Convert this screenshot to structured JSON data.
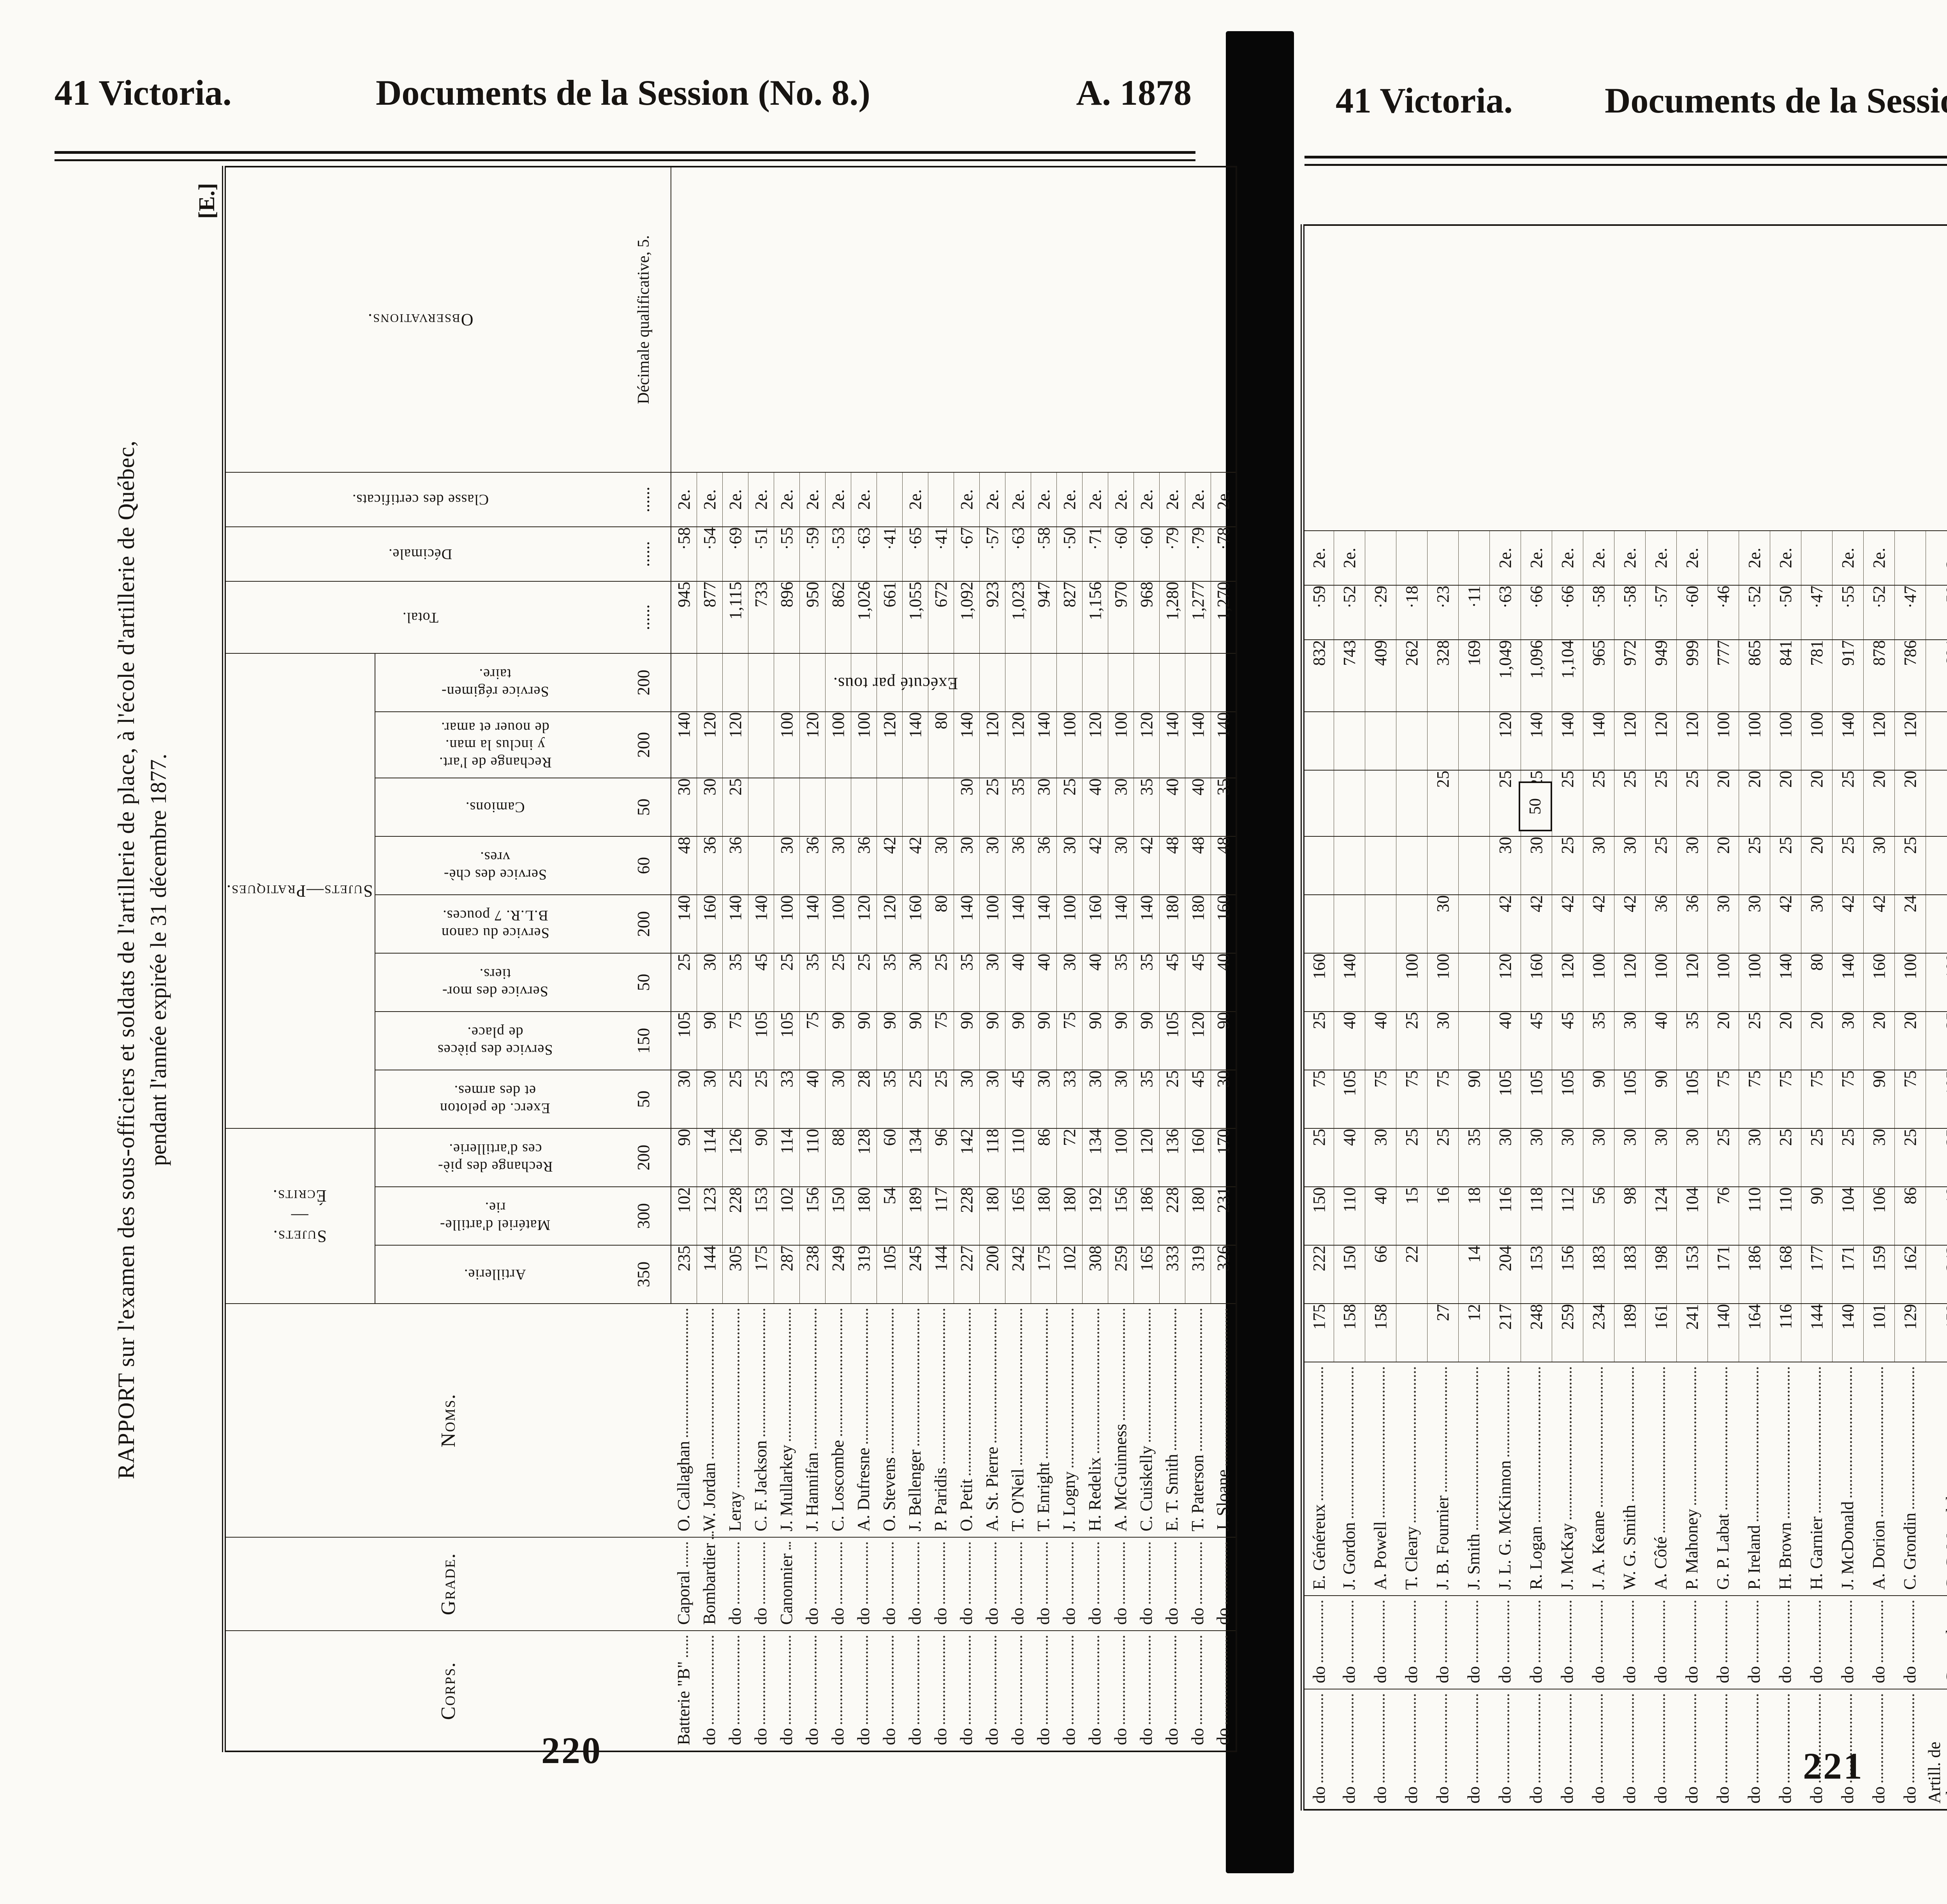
{
  "left_page": {
    "header_left": "41 Victoria.",
    "header_center": "Documents de la Session (No. 8.)",
    "header_right": "A. 1878",
    "section_mark": "[E.]",
    "title_line1": "RAPPORT sur l'examen des sous-officiers et soldats de l'artillerie de place, à l'école d'artillerie de Québec,",
    "title_line2": "pendant l'année expirée le 31 décembre 1877.",
    "page_number": "220"
  },
  "right_page": {
    "header_left": "41 Victoria.",
    "header_center": "Documents de la Session (No. 8.)",
    "header_right": "- 1878.",
    "page_number": "221",
    "signature_line1": "T. B. STRANGE, lieut.-colonel,",
    "signature_line2": "Commandant l'école d'artillerie, Québec."
  },
  "table": {
    "group_ecrits": "Sujets.\n—\nÉcrits.",
    "group_pratiques": "Sujets—Pratiques.",
    "h_corps": "Corps.",
    "h_grade": "Grade.",
    "h_noms": "Noms.",
    "h_art": "Artillerie.",
    "h_mat": "Matériel d'artille-\nrie.",
    "h_rchp": "Rechange des piè-\nces d'artillerie.",
    "h_pel": "Exerc. de peloton\net des armes.",
    "h_plc": "Service des pièces\nde place.",
    "h_mrt": "Service des mor-\ntiers.",
    "h_blr": "Service du canon\nB.L.R. 7 pouces.",
    "h_chv": "Service des chè-\nvres.",
    "h_cam": "Camions.",
    "h_rca": "Rechange de l'art.\ny inclus la man.\nde nouer et amar.",
    "h_srg": "Service régimen-\ntaire.",
    "h_tot": "Total.",
    "h_dec": "Décimale.",
    "h_cls": "Classe des certificats.",
    "h_obs": "Observations.",
    "obs_note": "Décimale qualificative, 5.",
    "execute_note": "Exécuté par tous.",
    "box_50": "50",
    "box_200": "200",
    "max": {
      "art": "350",
      "mat": "300",
      "rchp": "200",
      "pel": "50",
      "plc": "150",
      "mrt": "50",
      "blr": "200",
      "chv": "60",
      "cam": "50",
      "rca": "200",
      "srg": "200",
      "tot": "......",
      "dec": "......",
      "cls": "......"
    }
  },
  "rows_left": [
    {
      "corps": "Batterie \"B\"",
      "grade": "Caporal",
      "name": "O. Callaghan",
      "art": "235",
      "mat": "102",
      "rchp": "90",
      "pel": "30",
      "plc": "105",
      "mrt": "25",
      "blr": "140",
      "chv": "48",
      "cam": "30",
      "rca": "140",
      "srg": "",
      "tot": "945",
      "dec": "·58",
      "cls": "2e."
    },
    {
      "corps": "do",
      "grade": "Bombardier",
      "name": "W. Jordan",
      "art": "144",
      "mat": "123",
      "rchp": "114",
      "pel": "30",
      "plc": "90",
      "mrt": "30",
      "blr": "160",
      "chv": "36",
      "cam": "30",
      "rca": "120",
      "srg": "",
      "tot": "877",
      "dec": "·54",
      "cls": "2e."
    },
    {
      "corps": "do",
      "grade": "do",
      "name": "Leray",
      "art": "305",
      "mat": "228",
      "rchp": "126",
      "pel": "25",
      "plc": "75",
      "mrt": "35",
      "blr": "140",
      "chv": "36",
      "cam": "25",
      "rca": "120",
      "srg": "",
      "tot": "1,115",
      "dec": "·69",
      "cls": "2e."
    },
    {
      "corps": "do",
      "grade": "do",
      "name": "C. F. Jackson",
      "art": "175",
      "mat": "153",
      "rchp": "90",
      "pel": "25",
      "plc": "105",
      "mrt": "45",
      "blr": "140",
      "chv": "",
      "cam": "",
      "rca": "",
      "srg": "",
      "tot": "733",
      "dec": "·51",
      "cls": "2e."
    },
    {
      "corps": "do",
      "grade": "Canonnier",
      "name": "J. Mullarkey",
      "art": "287",
      "mat": "102",
      "rchp": "114",
      "pel": "33",
      "plc": "105",
      "mrt": "25",
      "blr": "100",
      "chv": "30",
      "cam": "",
      "rca": "100",
      "srg": "",
      "tot": "896",
      "dec": "·55",
      "cls": "2e."
    },
    {
      "corps": "do",
      "grade": "do",
      "name": "J. Hannifan",
      "art": "238",
      "mat": "156",
      "rchp": "110",
      "pel": "40",
      "plc": "75",
      "mrt": "35",
      "blr": "140",
      "chv": "36",
      "cam": "",
      "rca": "120",
      "srg": "",
      "tot": "950",
      "dec": "·59",
      "cls": "2e."
    },
    {
      "corps": "do",
      "grade": "do",
      "name": "C. Loscombe",
      "art": "249",
      "mat": "150",
      "rchp": "88",
      "pel": "30",
      "plc": "90",
      "mrt": "25",
      "blr": "100",
      "chv": "30",
      "cam": "",
      "rca": "100",
      "srg": "",
      "tot": "862",
      "dec": "·53",
      "cls": "2e."
    },
    {
      "corps": "do",
      "grade": "do",
      "name": "A. Dufresne",
      "art": "319",
      "mat": "180",
      "rchp": "128",
      "pel": "28",
      "plc": "90",
      "mrt": "25",
      "blr": "120",
      "chv": "36",
      "cam": "",
      "rca": "100",
      "srg": "",
      "tot": "1,026",
      "dec": "·63",
      "cls": "2e."
    },
    {
      "corps": "do",
      "grade": "do",
      "name": "O. Stevens",
      "art": "105",
      "mat": "54",
      "rchp": "60",
      "pel": "35",
      "plc": "90",
      "mrt": "35",
      "blr": "120",
      "chv": "42",
      "cam": "",
      "rca": "120",
      "srg": "",
      "tot": "661",
      "dec": "·41",
      "cls": ""
    },
    {
      "corps": "do",
      "grade": "do",
      "name": "J. Bellenger",
      "art": "245",
      "mat": "189",
      "rchp": "134",
      "pel": "25",
      "plc": "90",
      "mrt": "30",
      "blr": "160",
      "chv": "42",
      "cam": "",
      "rca": "140",
      "srg": "",
      "tot": "1,055",
      "dec": "·65",
      "cls": "2e."
    },
    {
      "corps": "do",
      "grade": "do",
      "name": "P. Paridis",
      "art": "144",
      "mat": "117",
      "rchp": "96",
      "pel": "25",
      "plc": "75",
      "mrt": "25",
      "blr": "80",
      "chv": "30",
      "cam": "",
      "rca": "80",
      "srg": "",
      "tot": "672",
      "dec": "·41",
      "cls": ""
    },
    {
      "corps": "do",
      "grade": "do",
      "name": "O. Petit",
      "art": "227",
      "mat": "228",
      "rchp": "142",
      "pel": "30",
      "plc": "90",
      "mrt": "35",
      "blr": "140",
      "chv": "30",
      "cam": "30",
      "rca": "140",
      "srg": "",
      "tot": "1,092",
      "dec": "·67",
      "cls": "2e."
    },
    {
      "corps": "do",
      "grade": "do",
      "name": "A. St. Pierre",
      "art": "200",
      "mat": "180",
      "rchp": "118",
      "pel": "30",
      "plc": "90",
      "mrt": "30",
      "blr": "100",
      "chv": "30",
      "cam": "25",
      "rca": "120",
      "srg": "",
      "tot": "923",
      "dec": "·57",
      "cls": "2e."
    },
    {
      "corps": "do",
      "grade": "do",
      "name": "T. O'Neil",
      "art": "242",
      "mat": "165",
      "rchp": "110",
      "pel": "45",
      "plc": "90",
      "mrt": "40",
      "blr": "140",
      "chv": "36",
      "cam": "35",
      "rca": "120",
      "srg": "",
      "tot": "1,023",
      "dec": "·63",
      "cls": "2e."
    },
    {
      "corps": "do",
      "grade": "do",
      "name": "T. Enright",
      "art": "175",
      "mat": "180",
      "rchp": "86",
      "pel": "30",
      "plc": "90",
      "mrt": "40",
      "blr": "140",
      "chv": "36",
      "cam": "30",
      "rca": "140",
      "srg": "",
      "tot": "947",
      "dec": "·58",
      "cls": "2e."
    },
    {
      "corps": "do",
      "grade": "do",
      "name": "J. Logny",
      "art": "102",
      "mat": "180",
      "rchp": "72",
      "pel": "33",
      "plc": "75",
      "mrt": "30",
      "blr": "100",
      "chv": "30",
      "cam": "25",
      "rca": "100",
      "srg": "",
      "tot": "827",
      "dec": "·50",
      "cls": "2e."
    },
    {
      "corps": "do",
      "grade": "do",
      "name": "H. Redelix",
      "art": "308",
      "mat": "192",
      "rchp": "134",
      "pel": "30",
      "plc": "90",
      "mrt": "40",
      "blr": "160",
      "chv": "42",
      "cam": "40",
      "rca": "120",
      "srg": "",
      "tot": "1,156",
      "dec": "·71",
      "cls": "2e."
    },
    {
      "corps": "do",
      "grade": "do",
      "name": "A. McGuinness",
      "art": "259",
      "mat": "156",
      "rchp": "100",
      "pel": "30",
      "plc": "90",
      "mrt": "35",
      "blr": "140",
      "chv": "30",
      "cam": "30",
      "rca": "100",
      "srg": "",
      "tot": "970",
      "dec": "·60",
      "cls": "2e."
    },
    {
      "corps": "do",
      "grade": "do",
      "name": "C. Cuiskelly",
      "art": "165",
      "mat": "186",
      "rchp": "120",
      "pel": "35",
      "plc": "90",
      "mrt": "35",
      "blr": "140",
      "chv": "42",
      "cam": "35",
      "rca": "120",
      "srg": "",
      "tot": "968",
      "dec": "·60",
      "cls": "2e."
    },
    {
      "corps": "do",
      "grade": "do",
      "name": "E. T. Smith",
      "art": "333",
      "mat": "228",
      "rchp": "136",
      "pel": "25",
      "plc": "105",
      "mrt": "45",
      "blr": "180",
      "chv": "48",
      "cam": "40",
      "rca": "140",
      "srg": "",
      "tot": "1,280",
      "dec": "·79",
      "cls": "2e."
    },
    {
      "corps": "do",
      "grade": "do",
      "name": "T. Paterson",
      "art": "319",
      "mat": "180",
      "rchp": "160",
      "pel": "45",
      "plc": "120",
      "mrt": "45",
      "blr": "180",
      "chv": "48",
      "cam": "40",
      "rca": "140",
      "srg": "",
      "tot": "1,277",
      "dec": "·79",
      "cls": "2e."
    },
    {
      "corps": "do",
      "grade": "do",
      "name": "J. Sloane",
      "art": "326",
      "mat": "231",
      "rchp": "170",
      "pel": "30",
      "plc": "90",
      "mrt": "40",
      "blr": "160",
      "chv": "48",
      "cam": "35",
      "rca": "140",
      "srg": "",
      "tot": "1,270",
      "dec": "·78",
      "cls": "2e."
    }
  ],
  "rows_right": [
    {
      "corps": "do",
      "grade": "do",
      "name": "E. Généreux",
      "art": "175",
      "mat": "222",
      "rchp": "150",
      "pel": "25",
      "plc": "75",
      "mrt": "25",
      "blr": "160",
      "chv": "",
      "cam": "",
      "rca": "",
      "srg": "",
      "tot": "832",
      "dec": "·59",
      "cls": "2e."
    },
    {
      "corps": "do",
      "grade": "do",
      "name": "J. Gordon",
      "art": "158",
      "mat": "150",
      "rchp": "110",
      "pel": "40",
      "plc": "105",
      "mrt": "40",
      "blr": "140",
      "chv": "",
      "cam": "",
      "rca": "",
      "srg": "",
      "tot": "743",
      "dec": "·52",
      "cls": "2e."
    },
    {
      "corps": "do",
      "grade": "do",
      "name": "A. Powell",
      "art": "158",
      "mat": "66",
      "rchp": "40",
      "pel": "30",
      "plc": "75",
      "mrt": "40",
      "blr": "",
      "chv": "",
      "cam": "",
      "rca": "",
      "srg": "",
      "tot": "409",
      "dec": "·29",
      "cls": ""
    },
    {
      "corps": "do",
      "grade": "do",
      "name": "T. Cleary",
      "art": "",
      "mat": "22",
      "rchp": "15",
      "pel": "25",
      "plc": "75",
      "mrt": "25",
      "blr": "100",
      "chv": "",
      "cam": "",
      "rca": "",
      "srg": "",
      "tot": "262",
      "dec": "·18",
      "cls": ""
    },
    {
      "corps": "do",
      "grade": "do",
      "name": "J. B. Fournier",
      "art": "27",
      "mat": "",
      "rchp": "16",
      "pel": "25",
      "plc": "75",
      "mrt": "30",
      "blr": "100",
      "chv": "30",
      "cam": "",
      "rca": "25",
      "srg": "",
      "tot": "328",
      "dec": "·23",
      "cls": ""
    },
    {
      "corps": "do",
      "grade": "do",
      "name": "J. Smith",
      "art": "12",
      "mat": "14",
      "rchp": "18",
      "pel": "35",
      "plc": "90",
      "mrt": "",
      "blr": "",
      "chv": "",
      "cam": "",
      "rca": "",
      "srg": "",
      "tot": "169",
      "dec": "·11",
      "cls": ""
    },
    {
      "corps": "do",
      "grade": "do",
      "name": "J. L. G. McKinnon",
      "art": "217",
      "mat": "204",
      "rchp": "116",
      "pel": "30",
      "plc": "105",
      "mrt": "40",
      "blr": "120",
      "chv": "42",
      "cam": "30",
      "rca": "25",
      "srg": "120",
      "tot": "1,049",
      "dec": "·63",
      "cls": "2e."
    },
    {
      "corps": "do",
      "grade": "do",
      "name": "R. Logan",
      "art": "248",
      "mat": "153",
      "rchp": "118",
      "pel": "30",
      "plc": "105",
      "mrt": "45",
      "blr": "160",
      "chv": "42",
      "cam": "30",
      "rca": "25",
      "srg": "140",
      "tot": "1,096",
      "dec": "·66",
      "cls": "2e."
    },
    {
      "corps": "do",
      "grade": "do",
      "name": "J. McKay",
      "art": "259",
      "mat": "156",
      "rchp": "112",
      "pel": "30",
      "plc": "105",
      "mrt": "45",
      "blr": "120",
      "chv": "42",
      "cam": "25",
      "rca": "25",
      "srg": "140",
      "tot": "1,104",
      "dec": "·66",
      "cls": "2e."
    },
    {
      "corps": "do",
      "grade": "do",
      "name": "J. A. Keane",
      "art": "234",
      "mat": "183",
      "rchp": "56",
      "pel": "30",
      "plc": "90",
      "mrt": "35",
      "blr": "100",
      "chv": "42",
      "cam": "30",
      "rca": "25",
      "srg": "140",
      "tot": "965",
      "dec": "·58",
      "cls": "2e."
    },
    {
      "corps": "do",
      "grade": "do",
      "name": "W. G. Smith",
      "art": "189",
      "mat": "183",
      "rchp": "98",
      "pel": "30",
      "plc": "105",
      "mrt": "30",
      "blr": "120",
      "chv": "42",
      "cam": "30",
      "rca": "25",
      "srg": "120",
      "tot": "972",
      "dec": "·58",
      "cls": "2e."
    },
    {
      "corps": "do",
      "grade": "do",
      "name": "A. Côté",
      "art": "161",
      "mat": "198",
      "rchp": "124",
      "pel": "30",
      "plc": "90",
      "mrt": "40",
      "blr": "100",
      "chv": "36",
      "cam": "25",
      "rca": "25",
      "srg": "120",
      "tot": "949",
      "dec": "·57",
      "cls": "2e."
    },
    {
      "corps": "do",
      "grade": "do",
      "name": "P. Mahoney",
      "art": "241",
      "mat": "153",
      "rchp": "104",
      "pel": "30",
      "plc": "105",
      "mrt": "35",
      "blr": "120",
      "chv": "36",
      "cam": "30",
      "rca": "25",
      "srg": "120",
      "tot": "999",
      "dec": "·60",
      "cls": "2e."
    },
    {
      "corps": "do",
      "grade": "do",
      "name": "G. P. Labat",
      "art": "140",
      "mat": "171",
      "rchp": "76",
      "pel": "25",
      "plc": "75",
      "mrt": "20",
      "blr": "100",
      "chv": "30",
      "cam": "20",
      "rca": "20",
      "srg": "100",
      "tot": "777",
      "dec": "·46",
      "cls": ""
    },
    {
      "corps": "do",
      "grade": "do",
      "name": "P. Ireland",
      "art": "164",
      "mat": "186",
      "rchp": "110",
      "pel": "30",
      "plc": "75",
      "mrt": "25",
      "blr": "100",
      "chv": "30",
      "cam": "25",
      "rca": "20",
      "srg": "100",
      "tot": "865",
      "dec": "·52",
      "cls": "2e."
    },
    {
      "corps": "do",
      "grade": "do",
      "name": "H. Brown",
      "art": "116",
      "mat": "168",
      "rchp": "110",
      "pel": "25",
      "plc": "75",
      "mrt": "20",
      "blr": "140",
      "chv": "42",
      "cam": "25",
      "rca": "20",
      "srg": "100",
      "tot": "841",
      "dec": "·50",
      "cls": "2e."
    },
    {
      "corps": "do",
      "grade": "do",
      "name": "H. Garnier",
      "art": "144",
      "mat": "177",
      "rchp": "90",
      "pel": "25",
      "plc": "75",
      "mrt": "20",
      "blr": "80",
      "chv": "30",
      "cam": "20",
      "rca": "20",
      "srg": "100",
      "tot": "781",
      "dec": "·47",
      "cls": ""
    },
    {
      "corps": "do",
      "grade": "do",
      "name": "J. McDonald",
      "art": "140",
      "mat": "171",
      "rchp": "104",
      "pel": "25",
      "plc": "75",
      "mrt": "30",
      "blr": "140",
      "chv": "42",
      "cam": "25",
      "rca": "25",
      "srg": "140",
      "tot": "917",
      "dec": "·55",
      "cls": "2e."
    },
    {
      "corps": "do",
      "grade": "do",
      "name": "A. Dorion",
      "art": "101",
      "mat": "159",
      "rchp": "106",
      "pel": "30",
      "plc": "90",
      "mrt": "20",
      "blr": "160",
      "chv": "42",
      "cam": "30",
      "rca": "20",
      "srg": "120",
      "tot": "878",
      "dec": "·52",
      "cls": "2e."
    },
    {
      "corps": "do",
      "grade": "do",
      "name": "C. Grondin",
      "art": "129",
      "mat": "162",
      "rchp": "86",
      "pel": "25",
      "plc": "75",
      "mrt": "20",
      "blr": "100",
      "chv": "24",
      "cam": "25",
      "rca": "20",
      "srg": "120",
      "tot": "786",
      "dec": "·47",
      "cls": ""
    },
    {
      "corps": "Artill. de place,\nMontréal",
      "grade": "Caporal",
      "name": "G. C. Mondelet",
      "art": "158",
      "mat": "243",
      "rchp": "18",
      "pel": "25",
      "plc": "105",
      "mrt": "35",
      "blr": "100",
      "chv": "",
      "cam": "",
      "rca": "",
      "srg": "",
      "tot": "684",
      "dec": "·50",
      "cls": "2e."
    },
    {
      "corps": "Batterie de cam-\npagne, Québec",
      "grade": "Bombardier",
      "name": "A. Leray",
      "art": "305",
      "mat": "228",
      "rchp": "126",
      "pel": "25",
      "plc": "75",
      "mrt": "35",
      "blr": "140",
      "chv": "36",
      "cam": "25",
      "rca": "120",
      "srg": "",
      "tot": "1,115",
      "dec": "·69",
      "cls": "2e."
    },
    {
      "corps": "Batterie No. 7,\nbrigade d'ar-\ntillerie de pla-\nce, Nouveau-\nBrunswick",
      "grade": "Caporal",
      "name": "D. Allen",
      "art": "140",
      "mat": "186",
      "rchp": "128",
      "pel": "25",
      "plc": "120",
      "mrt": "40",
      "blr": "140",
      "chv": "36",
      "cam": "35",
      "rca": "120",
      "srg": "",
      "tot": "970",
      "dec": "·60",
      "cls": "2e."
    },
    {
      "corps": "do",
      "grade": "Canonnier",
      "name": "J. McDonald",
      "art": "221",
      "mat": "189",
      "rchp": "134",
      "pel": "25",
      "plc": "105",
      "mrt": "40",
      "blr": "140",
      "chv": "36",
      "cam": "35",
      "rca": "100",
      "srg": "",
      "tot": "1,025",
      "dec": "·63",
      "cls": "2e."
    },
    {
      "corps": "do",
      "grade": "do",
      "name": "A. McArthur",
      "art": "",
      "mat": "",
      "rchp": "",
      "pel": "25",
      "plc": "60",
      "mrt": "30",
      "blr": "60",
      "chv": "30",
      "cam": "30",
      "rca": "100",
      "srg": "",
      "tot": "335",
      "dec": "·44",
      "cls": ""
    }
  ]
}
